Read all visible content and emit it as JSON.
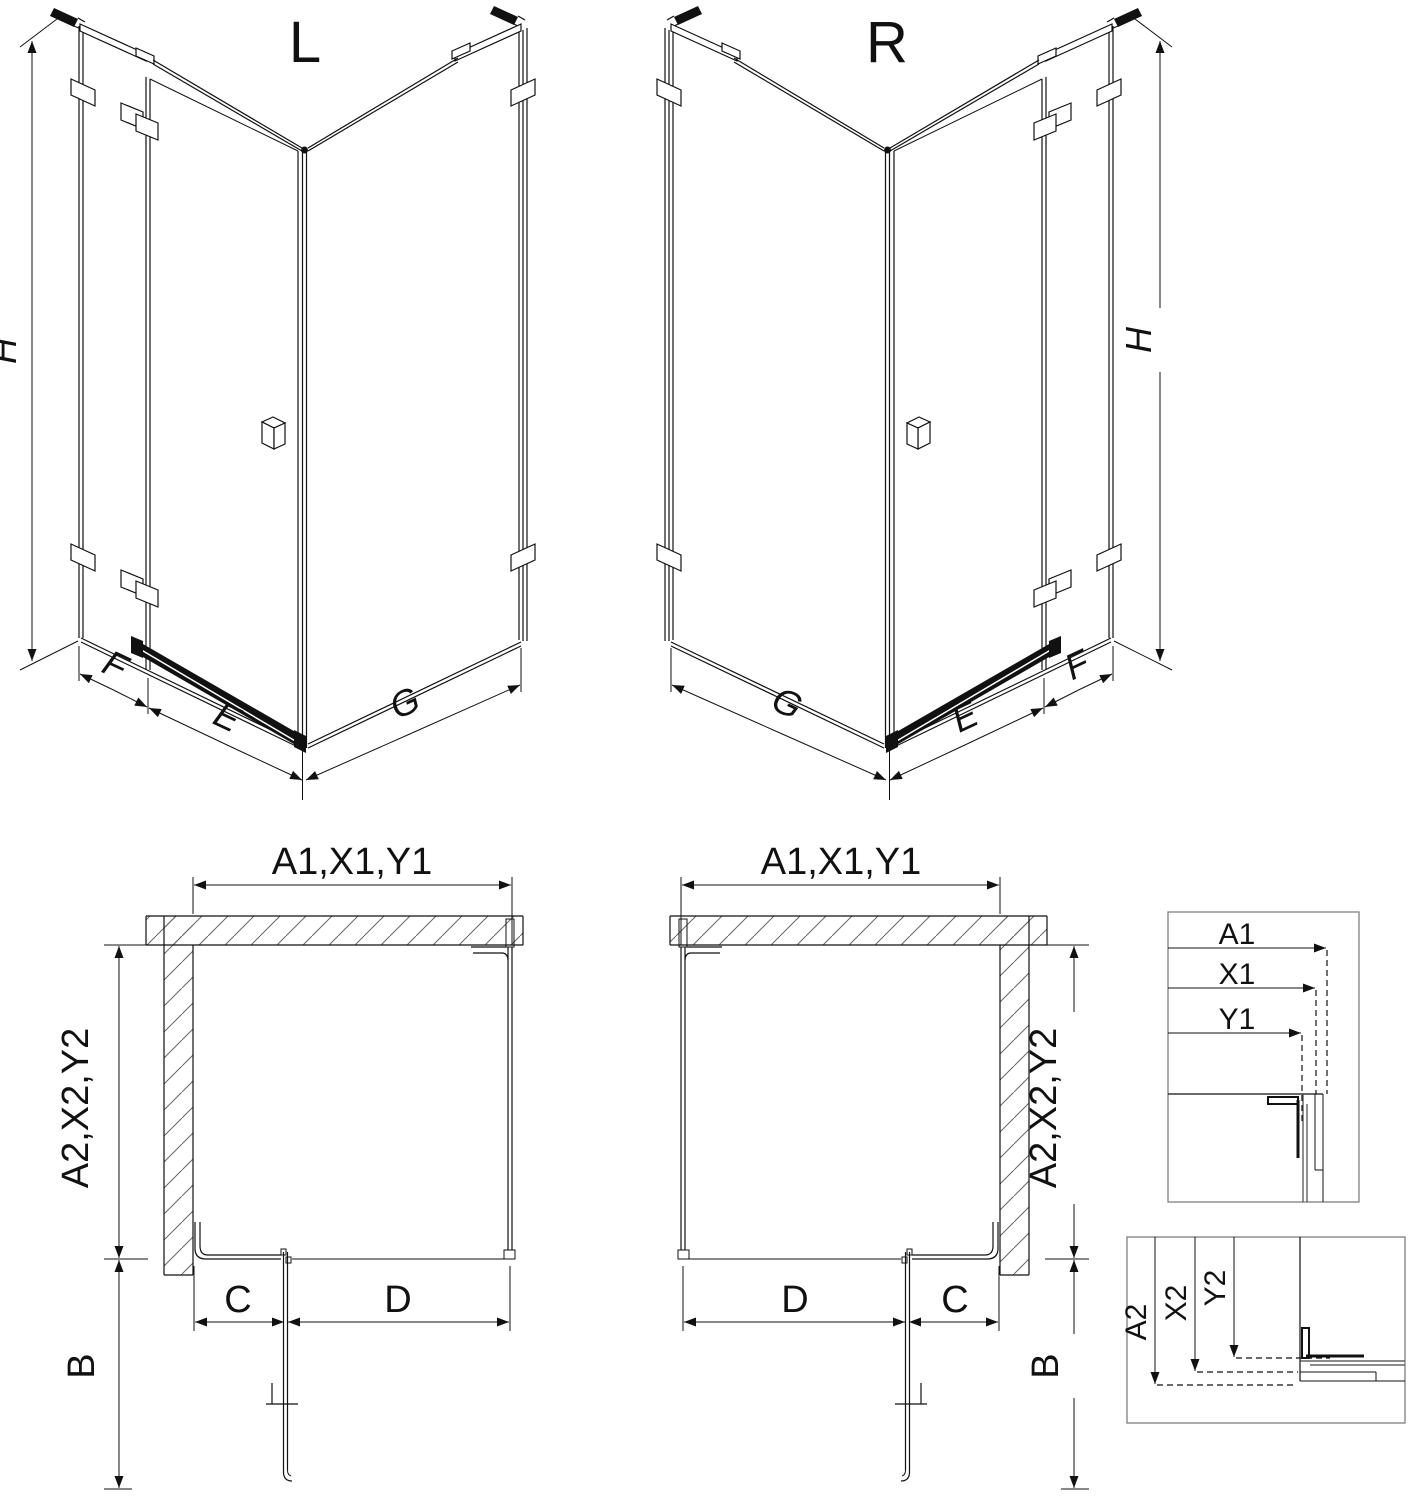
{
  "drawing": {
    "background": "#ffffff",
    "line_color": "#111111",
    "views": {
      "iso_left": {
        "title": "L",
        "height_dim": "H",
        "fixed_dim": "F",
        "door_dim": "E",
        "panel_dim": "G"
      },
      "iso_right": {
        "title": "R",
        "height_dim": "H",
        "fixed_dim": "F",
        "door_dim": "E",
        "panel_dim": "G"
      },
      "plan_left": {
        "width_dim": "A1,X1,Y1",
        "depth_dim": "A2,X2,Y2",
        "fixed_dim": "C",
        "door_dim": "D",
        "swing_dim": "B"
      },
      "plan_right": {
        "width_dim": "A1,X1,Y1",
        "depth_dim": "A2,X2,Y2",
        "fixed_dim": "C",
        "door_dim": "D",
        "swing_dim": "B"
      },
      "detail_width": {
        "dims": [
          "A1",
          "X1",
          "Y1"
        ]
      },
      "detail_depth": {
        "dims": [
          "A2",
          "X2",
          "Y2"
        ]
      }
    }
  }
}
